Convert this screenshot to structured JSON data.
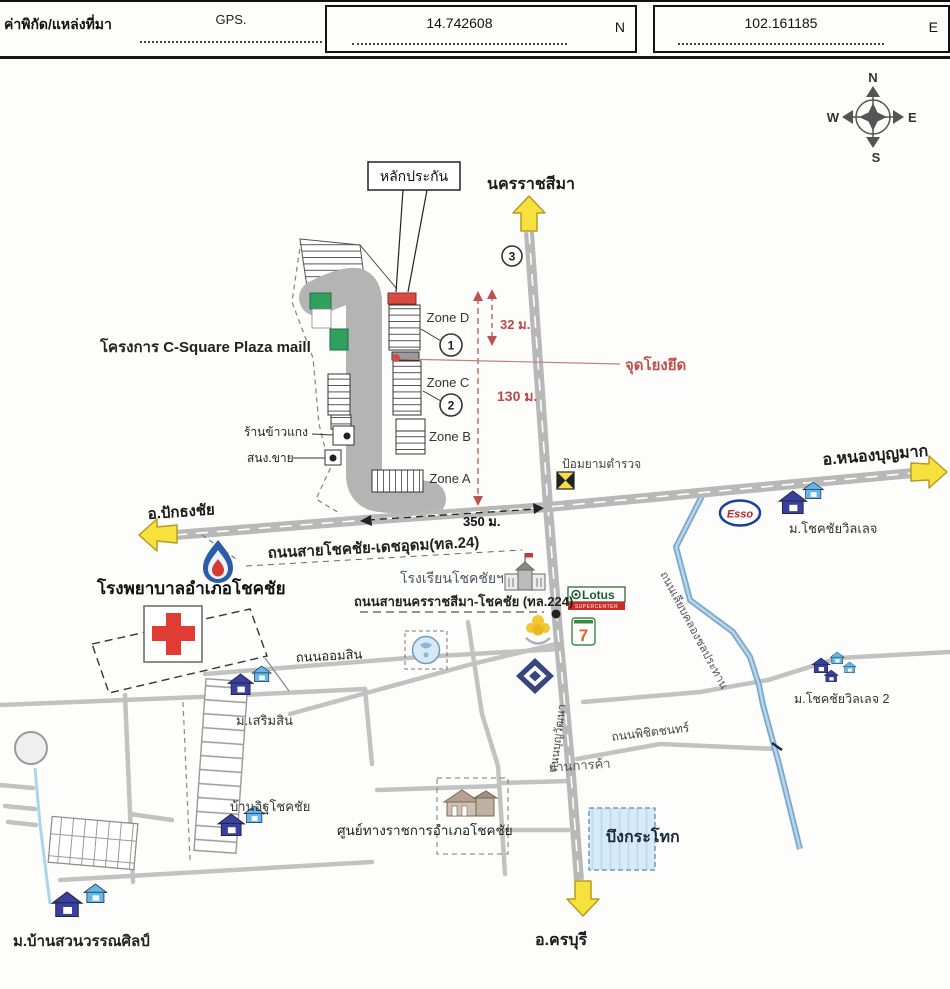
{
  "header": {
    "label": "ค่าพิกัด/แหล่งที่มา",
    "gps": "GPS.",
    "lat": "14.742608",
    "lat_dir": "N",
    "lon": "102.161185",
    "lon_dir": "E"
  },
  "compass": {
    "n": "N",
    "e": "E",
    "s": "S",
    "w": "W"
  },
  "plaza": {
    "tag": "หลักประกัน",
    "project": "โครงการ C-Square Plaza maill",
    "zones": {
      "d": "Zone D",
      "c": "Zone C",
      "b": "Zone B",
      "a": "Zone A"
    },
    "markers": {
      "m1": "1",
      "m2": "2",
      "m3": "3"
    },
    "rice_shop": "ร้านข้าวแกง",
    "sales_office": "สนง.ขาย",
    "anchor_label": "จุดโยงยึด"
  },
  "measurements": {
    "m32": "32 ม.",
    "m130": "130 ม.",
    "m350": "350 ม."
  },
  "destinations": {
    "north": "นครราชสีมา",
    "south": "อ.ครบุรี",
    "east": "อ.หนองบุญมาก",
    "west": "อ.ปักธงชัย"
  },
  "roads": {
    "hwy24": "ถนนสายโชคชัย-เดชอุดม(ทล.24)",
    "hwy224": "ถนนสายนครราชสีมา-โชคชัย (ทล.224)",
    "omsin": "ถนนออมสิน",
    "phichit": "ถนนพิชิตชนทร์",
    "boonwattana": "ถนนบุญวัฒนา",
    "canal_road": "ถนนเลียบคลองชลประทาน"
  },
  "places": {
    "police": "ป้อมยามตำรวจ",
    "hospital": "โรงพยาบาลอำเภอโชคชัย",
    "school": "โรงเรียนโชคชัยฯ",
    "village1": "ม.โชคชัยวิลเลจ",
    "village2": "ม.โชคชัยวิลเลจ 2",
    "sermsin": "ม.เสริมสิน",
    "brick_house": "บ้านอิฐโชคชัย",
    "gov_center": "ศูนย์ทางราชการอำเภอโชคชัย",
    "lake": "บึงกระโทก",
    "trade_area": "ย่านการค้า",
    "wannasin": "ม.บ้านสวนวรรณศิลป์"
  },
  "brands": {
    "esso": "Esso",
    "lotus": "Lotus",
    "lotus_sub": "SUPERCENTER",
    "seven": "7"
  },
  "colors": {
    "highway_arrow": "#f7e13c",
    "measure_red": "#c0504d",
    "green_block": "#2fa05e",
    "collateral_red": "#d84b42",
    "canal_blue": "#7aa8cc",
    "lake_fill": "#d6ebf7"
  }
}
